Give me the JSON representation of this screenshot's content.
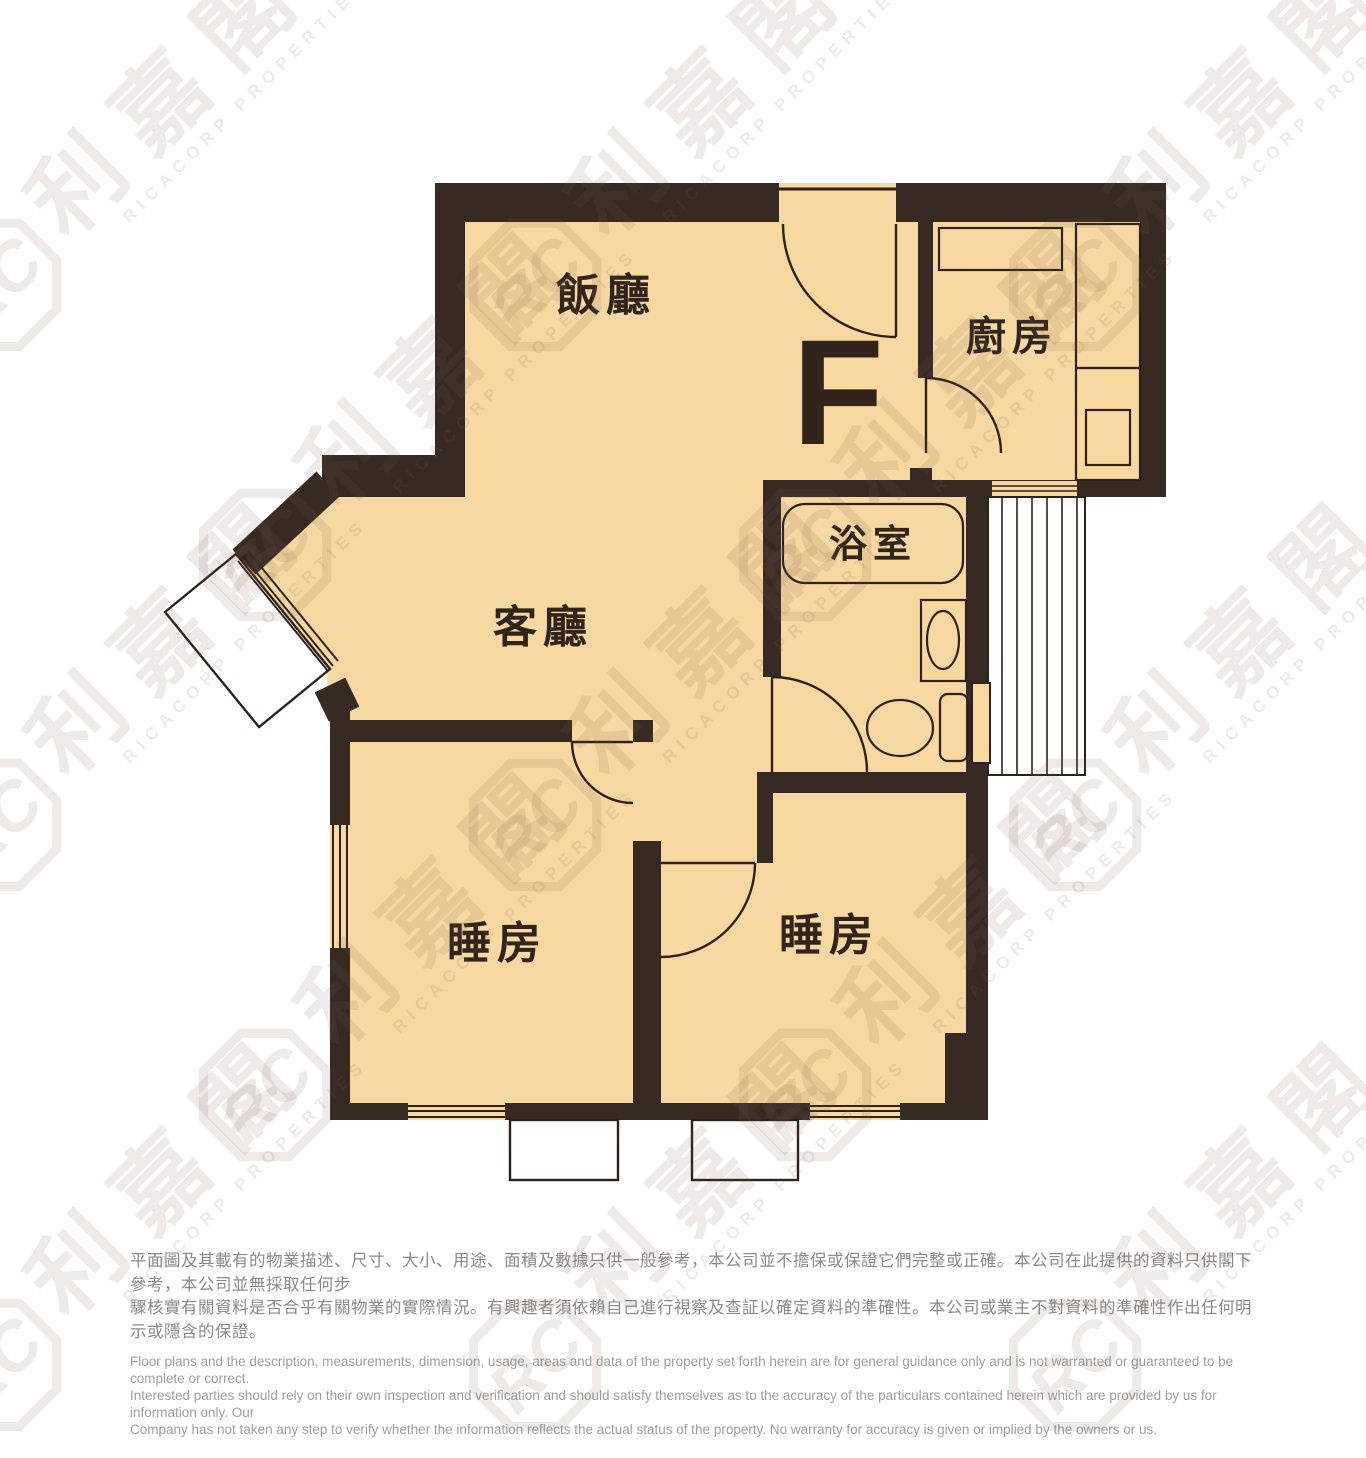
{
  "floorplan": {
    "unit_label": "F",
    "rooms": {
      "dining": {
        "label": "飯廳"
      },
      "kitchen": {
        "label": "廚房"
      },
      "bathroom": {
        "label": "浴室"
      },
      "living": {
        "label": "客廳"
      },
      "bedroom1": {
        "label": "睡房"
      },
      "bedroom2": {
        "label": "睡房"
      }
    },
    "colors": {
      "wall": "#362a23",
      "floor": "#f6d8a0",
      "line": "#2e2119"
    }
  },
  "watermark": {
    "logo_letters": "RC",
    "brand_cjk": "利嘉閣",
    "brand_en": "RICACORP PROPERTIES"
  },
  "disclaimer": {
    "chinese_lines": [
      "平面圖及其載有的物業描述、尺寸、大小、用途、面積及數據只供一般參考，本公司並不擔保或保證它們完整或正確。本公司在此提供的資料只供閣下參考，本公司並無採取任何步",
      "驟核實有關資料是否合乎有關物業的實際情況。有興趣者須依賴自己進行視察及查証以確定資料的準確性。本公司或業主不對資料的準確性作出任何明示或隱含的保證。"
    ],
    "english_lines": [
      "Floor plans and the description, measurements, dimension, usage, areas and data of the property set forth herein are for general guidance only and is not warranted or guaranteed to be complete or correct.",
      "Interested parties should rely on their own inspection and verification and should satisfy themselves as to the accuracy of the particulars contained herein which are provided by us for information only.  Our",
      "Company has not taken any step to verify whether the information reflects the actual status of the property.  No warranty for accuracy is given or implied by the owners or us."
    ]
  }
}
